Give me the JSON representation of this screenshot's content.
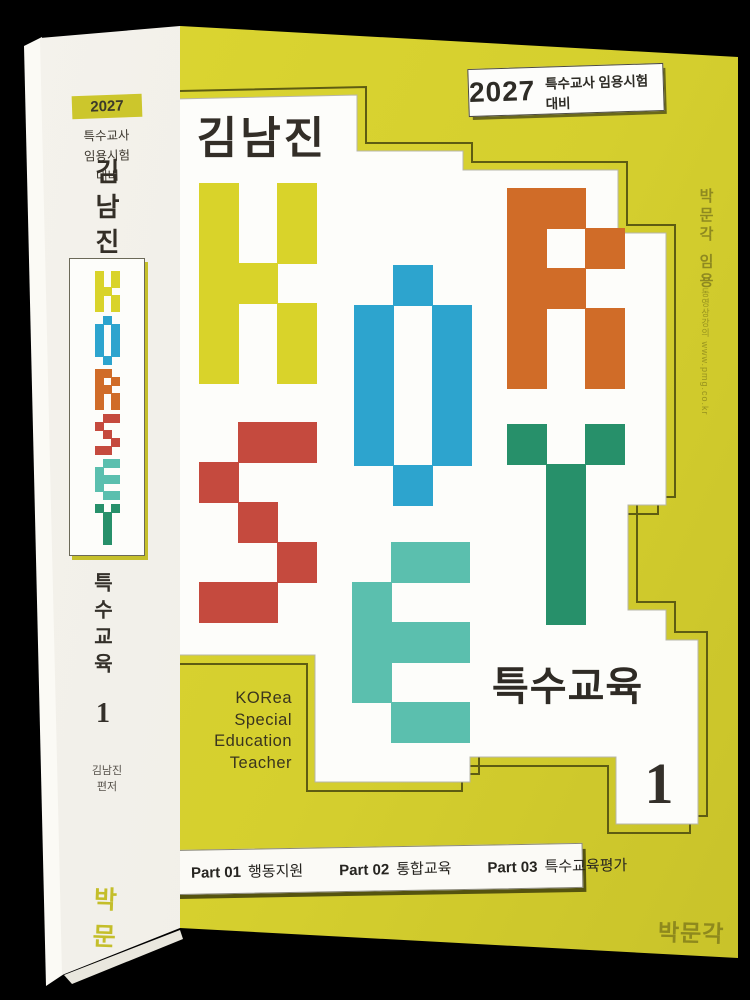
{
  "spine": {
    "badge_year": "2027",
    "subtitle_lines": [
      "특수교사",
      "임용시험",
      "대비"
    ],
    "author_vertical": "김남진",
    "series_title": "특수교육",
    "volume": "1",
    "author_credit_lines": [
      "김남진",
      "편저"
    ],
    "publisher": "박문각"
  },
  "cover": {
    "badge": {
      "year": "2027",
      "text": "특수교사 임용시험 대비"
    },
    "author": "김남진",
    "series_title": "특수교육",
    "volume": "1",
    "acronym_lines": [
      "KORea",
      "Special",
      "Education",
      "Teacher"
    ],
    "parts": [
      {
        "label": "Part 01",
        "title": "행동지원"
      },
      {
        "label": "Part 02",
        "title": "통합교육"
      },
      {
        "label": "Part 03",
        "title": "특수교육평가"
      }
    ],
    "publisher_logo": "박문각"
  },
  "side": {
    "vertical_text": "박문각 임용",
    "url_text": "동영상강의 www.pmg.co.kr"
  },
  "colors": {
    "background": "#000000",
    "cover_yellow": "#d5cf2e",
    "spine_white": "#f1efe9",
    "outline_olive": "#5e5c12",
    "text_dark": "#332e27",
    "publisher_olive": "#8e891d"
  },
  "korset": {
    "cell_width": 39,
    "cell_height": 40,
    "letters": [
      {
        "char": "K",
        "color": "#d9d32a",
        "x": 199,
        "y": 183,
        "grid": [
          "101",
          "101",
          "110",
          "101",
          "101"
        ]
      },
      {
        "char": "O",
        "color": "#2da4ce",
        "x": 354,
        "y": 265,
        "grid": [
          "010",
          "101",
          "101",
          "101",
          "101",
          "010"
        ]
      },
      {
        "char": "R",
        "color": "#d06c28",
        "x": 507,
        "y": 188,
        "grid": [
          "110",
          "101",
          "110",
          "101",
          "101"
        ]
      },
      {
        "char": "S",
        "color": "#c54a3e",
        "x": 199,
        "y": 422,
        "grid": [
          "011",
          "100",
          "010",
          "001",
          "110"
        ]
      },
      {
        "char": "E",
        "color": "#5bbfae",
        "x": 352,
        "y": 542,
        "grid": [
          "011",
          "100",
          "111",
          "100",
          "011"
        ]
      },
      {
        "char": "T",
        "color": "#27906a",
        "x": 507,
        "y": 424,
        "grid": [
          "101",
          "010",
          "010",
          "010",
          "010"
        ]
      }
    ]
  }
}
